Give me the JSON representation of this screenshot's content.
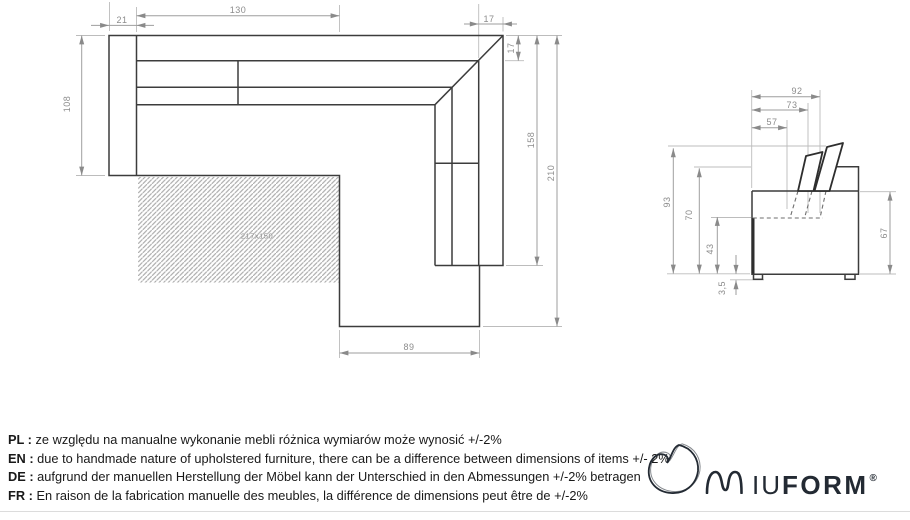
{
  "drawing": {
    "plan_dims": {
      "seat_width": "130",
      "armrest_width": "21",
      "backrest_top": "17",
      "backrest_side": "17",
      "depth": "108",
      "side_length": "158",
      "total_length": "210",
      "chaise_width": "89",
      "sleeping_area": "217x150"
    },
    "side_dims": {
      "depth_total": "92",
      "depth_mid": "73",
      "depth_seat": "57",
      "height_total": "93",
      "height_back": "70",
      "height_seat": "43",
      "foot_height": "3,5",
      "height_arm": "67"
    }
  },
  "notes": [
    {
      "label": "PL :",
      "text": "ze względu na manualne wykonanie mebli różnica wymiarów może wynosić +/-2%"
    },
    {
      "label": "EN :",
      "text": "due to handmade nature of upholstered furniture, there can be a difference between dimensions of items +/- 2%"
    },
    {
      "label": "DE :",
      "text": "aufgrund der manuellen Herstellung der Möbel kann der Unterschied in den Abmessungen +/-2% betragen"
    },
    {
      "label": "FR :",
      "text": "En raison de la fabrication manuelle des meubles, la différence de dimensions peut être de +/-2%"
    }
  ],
  "logo": {
    "text_iu": "IU",
    "text_form": "FORM",
    "registered": "®"
  },
  "colors": {
    "outline": "#3c3c3c",
    "dimension": "#9e9e9e",
    "logo": "#232a33"
  }
}
